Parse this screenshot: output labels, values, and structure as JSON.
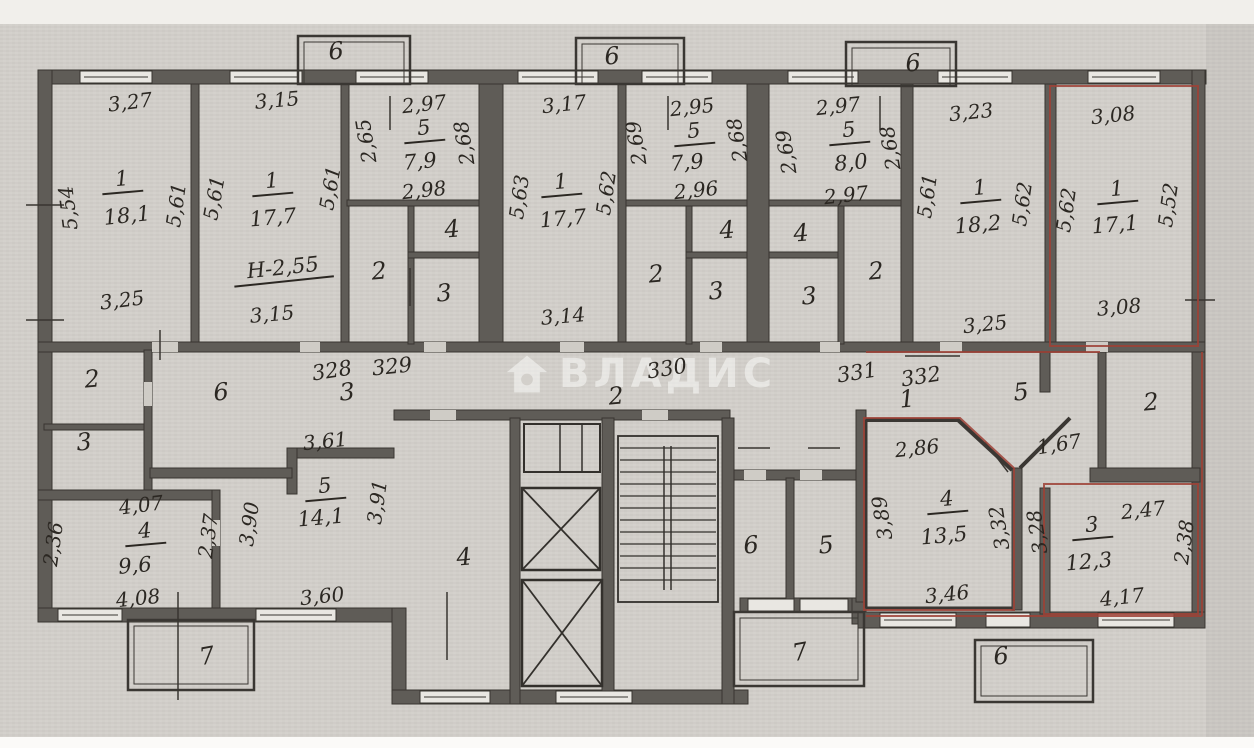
{
  "document": {
    "type": "scanned apartment floor plan",
    "watermark": {
      "text": "ВЛАДИС",
      "icon": "house-icon",
      "color": "rgba(250,250,248,0.55)"
    },
    "colors": {
      "paper": "#d3d0cb",
      "wall": "#5f5c57",
      "ink": "#2b2722",
      "highlight": "#9e4136"
    }
  },
  "unit_numbers": [
    "328",
    "329",
    "330",
    "331",
    "332"
  ],
  "room_areas": {
    "upper_rooms": [
      {
        "room": "1",
        "area": "18,1",
        "dims": [
          "3,27",
          "5,54",
          "5,61",
          "3,25"
        ]
      },
      {
        "room": "1",
        "area": "17,7",
        "dims": [
          "3,15",
          "5,61",
          "5,61",
          "3,15"
        ],
        "note": "Н-2,55"
      },
      {
        "room": "5",
        "area": "7,9",
        "dims": [
          "2,97",
          "2,65",
          "2,68",
          "2,98"
        ]
      },
      {
        "room": "1",
        "area": "17,7",
        "dims": [
          "3,17",
          "5,63",
          "5,62",
          "3,14"
        ]
      },
      {
        "room": "5",
        "area": "7,9",
        "dims": [
          "2,95",
          "2,69",
          "2,68",
          "2,96"
        ]
      },
      {
        "room": "5",
        "area": "8,0",
        "dims": [
          "2,97",
          "2,69",
          "2,68",
          "2,97"
        ]
      },
      {
        "room": "1",
        "area": "18,2",
        "dims": [
          "3,23",
          "5,61",
          "5,62",
          "3,25"
        ]
      },
      {
        "room": "1",
        "area": "17,1",
        "dims": [
          "3,08",
          "5,62",
          "5,52",
          "3,08"
        ],
        "highlighted": true
      }
    ],
    "lower_rooms": [
      {
        "room": "4",
        "area": "9,6",
        "dims": [
          "4,07",
          "2,36",
          "2,37",
          "4,08"
        ]
      },
      {
        "room": "5",
        "area": "14,1",
        "dims": [
          "3,61",
          "3,90",
          "3,91",
          "3,60"
        ]
      },
      {
        "room": "4",
        "area": "13,5",
        "dims": [
          "2,86",
          "3,89",
          "3,32",
          "3,46"
        ],
        "highlighted": true
      },
      {
        "room": "3",
        "area": "12,3",
        "dims": [
          "2,47",
          "3,28",
          "2,38",
          "4,17"
        ],
        "highlighted": true
      }
    ]
  },
  "annotations": [
    {
      "t": "3,27",
      "x": 130,
      "y": 102,
      "r": -7,
      "c": "dim"
    },
    {
      "t": "5,54",
      "x": 68,
      "y": 208,
      "r": -97,
      "c": "dim"
    },
    {
      "t": "5,61",
      "x": 176,
      "y": 205,
      "r": -82,
      "c": "dim"
    },
    {
      "t": "1",
      "x": 122,
      "y": 181,
      "r": -5,
      "c": "num"
    },
    {
      "t": "18,1",
      "x": 127,
      "y": 216,
      "r": -6,
      "c": "area"
    },
    {
      "t": "3,25",
      "x": 122,
      "y": 300,
      "r": -7,
      "c": "dim"
    },
    {
      "t": "3,15",
      "x": 277,
      "y": 100,
      "r": -5,
      "c": "dim"
    },
    {
      "t": "5,61",
      "x": 214,
      "y": 198,
      "r": -80,
      "c": "dim"
    },
    {
      "t": "5,61",
      "x": 330,
      "y": 188,
      "r": -80,
      "c": "dim"
    },
    {
      "t": "1",
      "x": 272,
      "y": 183,
      "r": -5,
      "c": "num"
    },
    {
      "t": "17,7",
      "x": 273,
      "y": 218,
      "r": -5,
      "c": "area"
    },
    {
      "t": "Н-2,55",
      "x": 283,
      "y": 270,
      "r": -6,
      "c": "num"
    },
    {
      "t": "3,15",
      "x": 272,
      "y": 314,
      "r": -5,
      "c": "dim"
    },
    {
      "t": "2,97",
      "x": 424,
      "y": 104,
      "r": -6,
      "c": "dim"
    },
    {
      "t": "2,65",
      "x": 366,
      "y": 141,
      "r": -99,
      "c": "dim"
    },
    {
      "t": "2,68",
      "x": 464,
      "y": 143,
      "r": -99,
      "c": "dim"
    },
    {
      "t": "5",
      "x": 424,
      "y": 130,
      "r": -5,
      "c": "num"
    },
    {
      "t": "7,9",
      "x": 420,
      "y": 162,
      "r": -5,
      "c": "area"
    },
    {
      "t": "2,98",
      "x": 424,
      "y": 190,
      "r": -6,
      "c": "dim"
    },
    {
      "t": "4",
      "x": 452,
      "y": 229,
      "r": -5,
      "c": "hall"
    },
    {
      "t": "2",
      "x": 379,
      "y": 271,
      "r": -5,
      "c": "hall"
    },
    {
      "t": "3",
      "x": 444,
      "y": 293,
      "r": -5,
      "c": "hall"
    },
    {
      "t": "3,17",
      "x": 564,
      "y": 104,
      "r": -6,
      "c": "dim"
    },
    {
      "t": "5,63",
      "x": 519,
      "y": 197,
      "r": -82,
      "c": "dim"
    },
    {
      "t": "5,62",
      "x": 606,
      "y": 193,
      "r": -82,
      "c": "dim"
    },
    {
      "t": "1",
      "x": 561,
      "y": 184,
      "r": -5,
      "c": "num"
    },
    {
      "t": "17,7",
      "x": 563,
      "y": 219,
      "r": -5,
      "c": "area"
    },
    {
      "t": "3,14",
      "x": 563,
      "y": 316,
      "r": -5,
      "c": "dim"
    },
    {
      "t": "2,95",
      "x": 692,
      "y": 107,
      "r": -6,
      "c": "dim"
    },
    {
      "t": "2,69",
      "x": 636,
      "y": 143,
      "r": -99,
      "c": "dim"
    },
    {
      "t": "2,68",
      "x": 737,
      "y": 140,
      "r": -99,
      "c": "dim"
    },
    {
      "t": "5",
      "x": 694,
      "y": 133,
      "r": -5,
      "c": "num"
    },
    {
      "t": "7,9",
      "x": 687,
      "y": 163,
      "r": -5,
      "c": "area"
    },
    {
      "t": "2,96",
      "x": 696,
      "y": 190,
      "r": -6,
      "c": "dim"
    },
    {
      "t": "4",
      "x": 727,
      "y": 230,
      "r": -5,
      "c": "hall"
    },
    {
      "t": "2",
      "x": 656,
      "y": 274,
      "r": -5,
      "c": "hall"
    },
    {
      "t": "3",
      "x": 716,
      "y": 291,
      "r": -5,
      "c": "hall"
    },
    {
      "t": "2,97",
      "x": 838,
      "y": 106,
      "r": -6,
      "c": "dim"
    },
    {
      "t": "2,69",
      "x": 786,
      "y": 152,
      "r": -99,
      "c": "dim"
    },
    {
      "t": "2,68",
      "x": 890,
      "y": 148,
      "r": -99,
      "c": "dim"
    },
    {
      "t": "5",
      "x": 849,
      "y": 132,
      "r": -5,
      "c": "num"
    },
    {
      "t": "8,0",
      "x": 851,
      "y": 163,
      "r": -5,
      "c": "area"
    },
    {
      "t": "2,97",
      "x": 846,
      "y": 195,
      "r": -6,
      "c": "dim"
    },
    {
      "t": "4",
      "x": 801,
      "y": 233,
      "r": -5,
      "c": "hall"
    },
    {
      "t": "3",
      "x": 809,
      "y": 296,
      "r": -5,
      "c": "hall"
    },
    {
      "t": "2",
      "x": 876,
      "y": 271,
      "r": -5,
      "c": "hall"
    },
    {
      "t": "5,61",
      "x": 927,
      "y": 196,
      "r": -82,
      "c": "dim"
    },
    {
      "t": "3,23",
      "x": 971,
      "y": 112,
      "r": -6,
      "c": "dim"
    },
    {
      "t": "1",
      "x": 980,
      "y": 190,
      "r": -5,
      "c": "num"
    },
    {
      "t": "18,2",
      "x": 978,
      "y": 225,
      "r": -5,
      "c": "area"
    },
    {
      "t": "5,62",
      "x": 1022,
      "y": 204,
      "r": -82,
      "c": "dim"
    },
    {
      "t": "3,25",
      "x": 985,
      "y": 324,
      "r": -6,
      "c": "dim"
    },
    {
      "t": "3,08",
      "x": 1113,
      "y": 115,
      "r": -6,
      "c": "dim"
    },
    {
      "t": "5,62",
      "x": 1066,
      "y": 210,
      "r": -82,
      "c": "dim"
    },
    {
      "t": "5,52",
      "x": 1168,
      "y": 205,
      "r": -82,
      "c": "dim"
    },
    {
      "t": "1",
      "x": 1117,
      "y": 191,
      "r": -5,
      "c": "num"
    },
    {
      "t": "17,1",
      "x": 1115,
      "y": 225,
      "r": -5,
      "c": "area"
    },
    {
      "t": "3,08",
      "x": 1119,
      "y": 307,
      "r": -5,
      "c": "dim"
    },
    {
      "t": "328",
      "x": 332,
      "y": 371,
      "r": -9,
      "c": "unit"
    },
    {
      "t": "329",
      "x": 392,
      "y": 367,
      "r": -6,
      "c": "unit"
    },
    {
      "t": "330",
      "x": 667,
      "y": 369,
      "r": -9,
      "c": "unit"
    },
    {
      "t": "331",
      "x": 857,
      "y": 373,
      "r": -9,
      "c": "unit"
    },
    {
      "t": "332",
      "x": 921,
      "y": 377,
      "r": -9,
      "c": "unit"
    },
    {
      "t": "2",
      "x": 616,
      "y": 396,
      "r": -5,
      "c": "hall"
    },
    {
      "t": "3",
      "x": 347,
      "y": 392,
      "r": -5,
      "c": "hall"
    },
    {
      "t": "1",
      "x": 907,
      "y": 399,
      "r": -5,
      "c": "hall"
    },
    {
      "t": "5",
      "x": 1021,
      "y": 392,
      "r": -5,
      "c": "hall"
    },
    {
      "t": "2",
      "x": 1151,
      "y": 402,
      "r": -5,
      "c": "hall"
    },
    {
      "t": "2",
      "x": 92,
      "y": 379,
      "r": -5,
      "c": "hall"
    },
    {
      "t": "3",
      "x": 84,
      "y": 442,
      "r": -5,
      "c": "hall"
    },
    {
      "t": "6",
      "x": 221,
      "y": 392,
      "r": -5,
      "c": "hall"
    },
    {
      "t": "3,61",
      "x": 325,
      "y": 441,
      "r": -6,
      "c": "dim"
    },
    {
      "t": "5",
      "x": 325,
      "y": 488,
      "r": -5,
      "c": "num"
    },
    {
      "t": "14,1",
      "x": 321,
      "y": 518,
      "r": -5,
      "c": "area"
    },
    {
      "t": "3,91",
      "x": 377,
      "y": 502,
      "r": -82,
      "c": "dim"
    },
    {
      "t": "3,90",
      "x": 249,
      "y": 524,
      "r": -82,
      "c": "dim"
    },
    {
      "t": "2,37",
      "x": 208,
      "y": 536,
      "r": -82,
      "c": "dim"
    },
    {
      "t": "4,07",
      "x": 141,
      "y": 505,
      "r": -7,
      "c": "dim"
    },
    {
      "t": "4",
      "x": 145,
      "y": 533,
      "r": -5,
      "c": "num"
    },
    {
      "t": "9,6",
      "x": 135,
      "y": 566,
      "r": -5,
      "c": "area"
    },
    {
      "t": "2,36",
      "x": 53,
      "y": 544,
      "r": -82,
      "c": "dim"
    },
    {
      "t": "4,08",
      "x": 138,
      "y": 598,
      "r": -6,
      "c": "dim"
    },
    {
      "t": "3,60",
      "x": 322,
      "y": 596,
      "r": -6,
      "c": "dim"
    },
    {
      "t": "7",
      "x": 207,
      "y": 656,
      "r": -10,
      "c": "hall"
    },
    {
      "t": "4",
      "x": 464,
      "y": 557,
      "r": -5,
      "c": "hall"
    },
    {
      "t": "6",
      "x": 751,
      "y": 545,
      "r": -5,
      "c": "hall"
    },
    {
      "t": "5",
      "x": 826,
      "y": 545,
      "r": -5,
      "c": "hall"
    },
    {
      "t": "7",
      "x": 800,
      "y": 652,
      "r": -10,
      "c": "hall"
    },
    {
      "t": "2,86",
      "x": 917,
      "y": 448,
      "r": -6,
      "c": "dim"
    },
    {
      "t": "4",
      "x": 947,
      "y": 501,
      "r": -5,
      "c": "num"
    },
    {
      "t": "13,5",
      "x": 944,
      "y": 536,
      "r": -5,
      "c": "area"
    },
    {
      "t": "3,89",
      "x": 882,
      "y": 518,
      "r": -99,
      "c": "dim"
    },
    {
      "t": "3,32",
      "x": 999,
      "y": 528,
      "r": -99,
      "c": "dim"
    },
    {
      "t": "3,46",
      "x": 947,
      "y": 594,
      "r": -6,
      "c": "dim"
    },
    {
      "t": "1,67",
      "x": 1059,
      "y": 444,
      "r": -9,
      "c": "dim"
    },
    {
      "t": "3,28",
      "x": 1037,
      "y": 532,
      "r": -99,
      "c": "dim"
    },
    {
      "t": "2,47",
      "x": 1143,
      "y": 510,
      "r": -6,
      "c": "dim"
    },
    {
      "t": "3",
      "x": 1092,
      "y": 527,
      "r": -5,
      "c": "num"
    },
    {
      "t": "12,3",
      "x": 1089,
      "y": 562,
      "r": -5,
      "c": "area"
    },
    {
      "t": "4,17",
      "x": 1122,
      "y": 597,
      "r": -6,
      "c": "dim"
    },
    {
      "t": "2,38",
      "x": 1184,
      "y": 542,
      "r": -82,
      "c": "dim"
    },
    {
      "t": "6",
      "x": 1001,
      "y": 656,
      "r": -5,
      "c": "hall"
    },
    {
      "t": "6",
      "x": 336,
      "y": 51,
      "r": -5,
      "c": "hall"
    },
    {
      "t": "6",
      "x": 612,
      "y": 56,
      "r": -5,
      "c": "hall"
    },
    {
      "t": "6",
      "x": 913,
      "y": 63,
      "r": -5,
      "c": "hall"
    }
  ]
}
